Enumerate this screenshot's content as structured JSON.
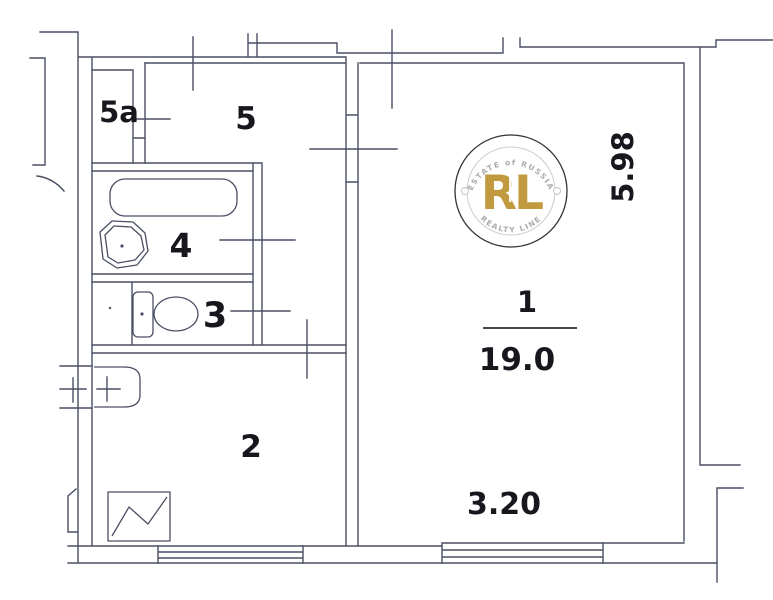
{
  "plan": {
    "type": "apartment-floor-plan",
    "background_color": "#ffffff",
    "wall_color": "#4a4f63",
    "label_color": "#17171d",
    "rooms": [
      {
        "number": "1",
        "area": "19.0"
      },
      {
        "number": "2"
      },
      {
        "number": "3"
      },
      {
        "number": "4"
      },
      {
        "number": "5"
      },
      {
        "number": "5a"
      }
    ],
    "dimensions": {
      "room1_width_m": "3.20",
      "room1_depth_m": "5.98"
    },
    "fixture_symbols": [
      "bathtub",
      "wash-basin",
      "toilet",
      "hall-basin",
      "cabinet-with-zigzag",
      "window",
      "window"
    ],
    "watermark": {
      "monogram": "RL",
      "arc_top_text": "ESTATE of RUSSIA",
      "arc_bottom_text": "REALTY LINE",
      "gold_color": "#c19a3f",
      "ring_color": "#333333",
      "secondary_color": "#ababab"
    }
  }
}
